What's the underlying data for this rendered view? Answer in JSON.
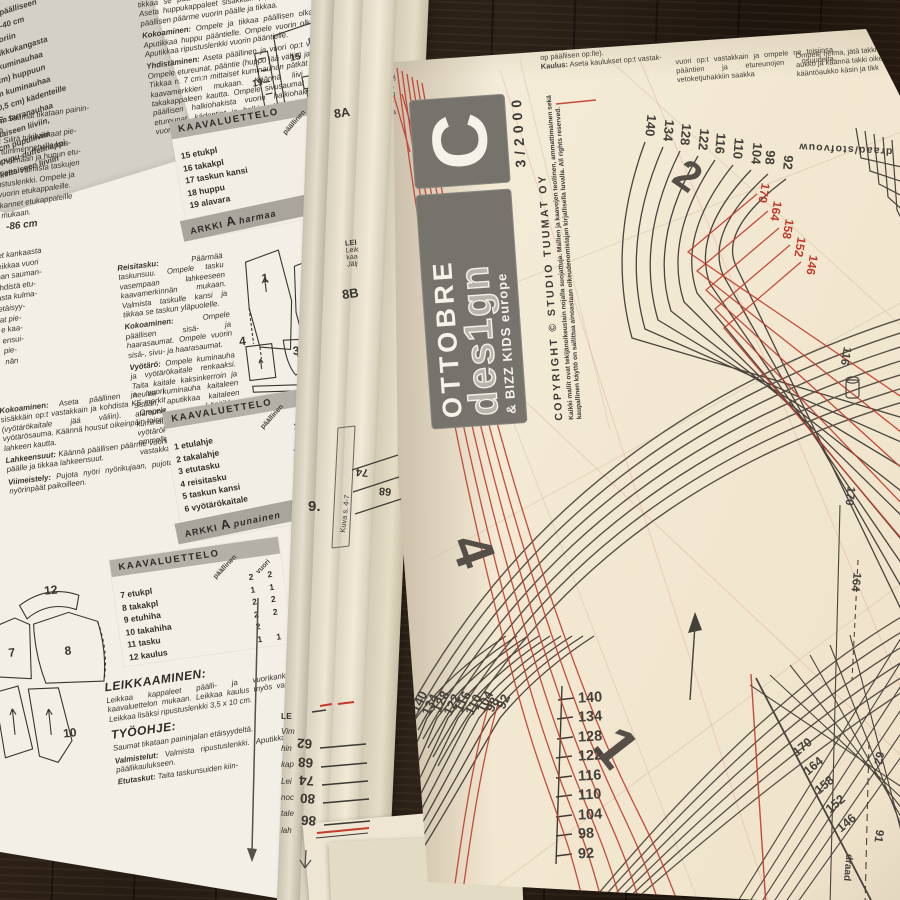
{
  "scene": {
    "description": "Open OTTOBRE design 3/2000 sewing pattern magazine with pattern sheet C lying on a dark wooden table"
  },
  "left_page": {
    "materials_box": {
      "lines": [
        "babycordaa päälliseen",
        "35-35-35-40-40 cm",
        "fleeceä vuoriin",
        "- 10 cm tilkkukangasta",
        "- 50 cm kuminauhaa",
        "  (lev. 1 cm) huppuun",
        "- 15 cm kuminauhaa",
        "  (lev. 0,5 cm) kädenteille",
        "- 9 cm tarranauhaa",
        "  keltaiseen liiviin,",
        "  6 cm pupuliiviin",
        "- pupu-duffelinappi",
        "  keltaiseen liiviin"
      ]
    },
    "hje_block": {
      "lead": "HJE:",
      "rest": " Saumat tikataan painin-",
      "lines": [
        "lyltä.",
        "lut: Silitä tukikankaat pie-",
        "ta tummennetuille kaa-",
        "ija helmaan ja hupun etu-",
        "rmeet. Valmista taskujen",
        "ustuslenkki. Ompele ja",
        "vuorin etukappaleille.",
        "kannet etukappaleille",
        "mukaan."
      ]
    },
    "size_note": "-86 cm",
    "frag_col": [
      "leet kankaasta",
      "Leikkaa vuori",
      "man sauman-",
      "yhdistä etu-",
      "asta kulma-",
      "etäisyy-",
      "at pie-",
      "e kaa-",
      "ensui-",
      "pie-",
      "nän"
    ],
    "top_col": {
      "p0": "tikkaa se päältään hupun etureunan saumanvaroihin. Aseta huppukappaleet sisäkkäin (np:t vastakkain), taita päällisen päärme vuorin päälle ja tikkaa.",
      "p1_lead": "Kokoaminen:",
      "p1": " Ompele ja tikkaa päällisen olkasaumat. Aputikkaa huppu pääntielle. Ompele vuorin olkasaumat. Aputikkaa ripustuslenkki vuorin pääntielle.",
      "p2_lead": "Yhdistäminen:",
      "p2": " Aseta päällinen ja vuori op:t vastakkain. Ompele etureunat, pääntie (huppu jää väliin) ja kädentiet. Tikkaa n. 7 cm:n mittaiset kuminauhan pätkät kädenteille kaavamerkkien mukaan. Käännä liivi oikeinpäin takakappaleen kautta. Ompele sivusaumat yhtenäisenä päällisen halkiohakista vuorin halkiohakkiin. Tikkaa etureunat, kädentiet ja halkiot. Käännä helmapäärme vuorin päälle ja tikkaa."
    },
    "kaava1": {
      "title": "KAAVALUETTELO",
      "col_a": "päällinen",
      "rows": [
        {
          "n": "15 etukpl",
          "a": "2"
        },
        {
          "n": "16 takakpl",
          "a": "1"
        },
        {
          "n": "17 taskun kansi",
          "a": "2"
        },
        {
          "n": "18 huppu",
          "a": "2"
        },
        {
          "n": "19 alavara",
          "a": "2"
        }
      ],
      "sheet": "ARKKI",
      "sheet_letter": "A",
      "sheet_color": "harmaa"
    },
    "mid_col": {
      "p0_lead": "Reisitasku:",
      "p0": " Päärmää taskunsuu. Ompele tasku vasempaan lahkeeseen kaavamerkinnän mukaan. Valmista taskulle kansi ja tikkaa se taskun yläpuolelle.",
      "p1_lead": "Kokoaminen:",
      "p1": " Ompele päällisen sisä- ja haarasaumat. Ompele vuorin sisä-, sivu- ja haarasaumat.",
      "p2_lead": "Vyötärö:",
      "p2": " Ompele kuminauha ja vyötärökaitale renkaaksi. Taita kaitale kaksinkerroin ja neulaa kuminauha kaitaleen sisään, aputikkaa kaitaleen alareuna. Läpitikkaa kuminauhaan nyörikuja vyötärökaitaleen keskelle. Venytä kuminauhaa kevyesti ommellessasi. Aputikkaa vyötärökaitale päälliseen op:t vastakkain."
    },
    "bottom_col": {
      "p0_lead": "Kokoaminen:",
      "p0": " Aseta päällinen ja vuori sisäkkäin op:t vastakkain ja kohdista KE-merkit (vyötärökaitale jää väliin). Ompele vyötärösauma. Käännä housut oikeinpäin toisen lahkeen kautta.",
      "p1_lead": "Lahkeensuut:",
      "p1": " Käännä päällisen päärme vuorin päälle ja tikkaa lahkeensuut.",
      "p2_lead": "Viimeistely:",
      "p2": " Pujota nyöri nyörikujaan, pujota nyörinpäät paikoilleen."
    },
    "kaava2": {
      "title": "KAAVALUETTELO",
      "col_a": "päällinen",
      "col_b": "vuori",
      "rows": [
        {
          "n": "1 etulahje",
          "a": "2",
          "b": "2"
        },
        {
          "n": "2 takalahje",
          "a": "2",
          "b": "2"
        },
        {
          "n": "3 etutasku",
          "a": "2+2",
          "b": ""
        },
        {
          "n": "4 reisitasku",
          "a": "1",
          "b": ""
        },
        {
          "n": "5 taskun kansi",
          "a": "1",
          "b": ""
        },
        {
          "n": "6 vyötärökaitale",
          "a": "1",
          "b": ""
        }
      ],
      "sheet": "ARKKI",
      "sheet_letter": "A",
      "sheet_color": "punainen"
    },
    "kaava3": {
      "title": "KAAVALUETTELO",
      "col_a": "päällinen",
      "col_b": "vuori",
      "rows": [
        {
          "n": "7 etukpl",
          "a": "2",
          "b": "2"
        },
        {
          "n": "8 takakpl",
          "a": "1",
          "b": "1"
        },
        {
          "n": "9 etuhiha",
          "a": "2",
          "b": "2"
        },
        {
          "n": "10 takahiha",
          "a": "2",
          "b": "2"
        },
        {
          "n": "11 tasku",
          "a": "2",
          "b": ""
        },
        {
          "n": "12 kaulus",
          "a": "1",
          "b": "1"
        }
      ]
    },
    "leikkaaminen": {
      "h": "LEIKKAAMINEN:",
      "p": "Leikkaa kappaleet päälli- ja vuorikankaasta kaavaluettelon mukaan. Leikkaa kaulus myös vanusta. Leikkaa lisäksi ripustuslenkki 3,5 x 10 cm.",
      "h2": "TYÖOHJE:",
      "p2": "Saumat tikataan paininjalan etäisyydeltä.",
      "p3_lead": "Valmistelut:",
      "p3": " Valmista ripustuslenkki. Aputikkaa vanu päällikaulukseen.",
      "p4_lead": "Etutaskut:",
      "p4": " Taita taskunsuiden kiin-"
    },
    "diagram1_labels": [
      "15",
      "16",
      "17",
      "18",
      "19"
    ],
    "diagram2_labels": [
      "1",
      "2",
      "3",
      "4",
      "5",
      "6"
    ],
    "diagram3_labels": [
      "7",
      "8",
      "10",
      "12"
    ]
  },
  "spine": {
    "edge_frags": [
      "LE",
      "Vim",
      "hin",
      "kap",
      "Lei",
      "noc",
      "tale",
      "lah"
    ],
    "scale": [
      "62",
      "68",
      "74",
      "80",
      "86"
    ],
    "label_74": "74",
    "label_68": "68",
    "label_8a": "8A",
    "label_8b": "8B",
    "label_9": "9.",
    "kuva": "Kuva s. 4-7",
    "lei_frags": [
      "LEI",
      "Leik",
      "kaa",
      "Jälj"
    ]
  },
  "sheet": {
    "top_col1": {
      "p": "seet nurjalle ja tikkaa. Ompele taskut paikoilleen kaavamerkkien mukaan.",
      "frags": [
        "Kok",
        "nyhöj",
        "tikka",
        "Omp",
        "vuor",
        "tikka"
      ]
    },
    "top_col2": {
      "p": "le. Ompele vetoketju päälliseen (ketjun op päällisen op:lle).",
      "p2_lead": "Kaulus:",
      "p2": " Aseta kaulukset op:t vastak-"
    },
    "top_col3": "vuori op:t vastakkain ja ompele ne toisiinsa pääntien ja etureunojen osuudelta vetoketjuhakkiin saakka",
    "top_col4": [
      "Ompele helma, jätä takki",
      "aukko ja käännä takki oikei",
      "kääntöaukko käsin ja tikk"
    ],
    "logo": {
      "brand": "OTTOBRE",
      "brand2": "des1gn",
      "brand3": "& BIZZ KIDS europe",
      "letter": "C",
      "issue": "3/2000",
      "copyright": "COPYRIGHT © STUDIO TUUMAT OY",
      "legal": "Kaikki mallit ovat tekijänoikeuslain nojalla suojattuja. Mallien ja kaavojen teollinen, ammattimainen sekä kaupallinen käyttö on sallittua ainoastaan oikeudenomistajan kirjallisella luvalla. All rights reserved."
    },
    "grain_label": "draad/stofvouw",
    "grain_label2": "draad",
    "piece_numbers": {
      "one": "1",
      "two": "2",
      "four": "4"
    },
    "sizes_black": [
      "140",
      "134",
      "128",
      "122",
      "116",
      "110",
      "104",
      "98",
      "92"
    ],
    "sizes_red": [
      "170",
      "164",
      "158",
      "152",
      "146"
    ],
    "sizes_diag": [
      "170",
      "164",
      "158",
      "152",
      "146"
    ],
    "size_116": "116",
    "size_170": "170",
    "size_164": "164",
    "size_91": "91",
    "size_62": "62"
  }
}
